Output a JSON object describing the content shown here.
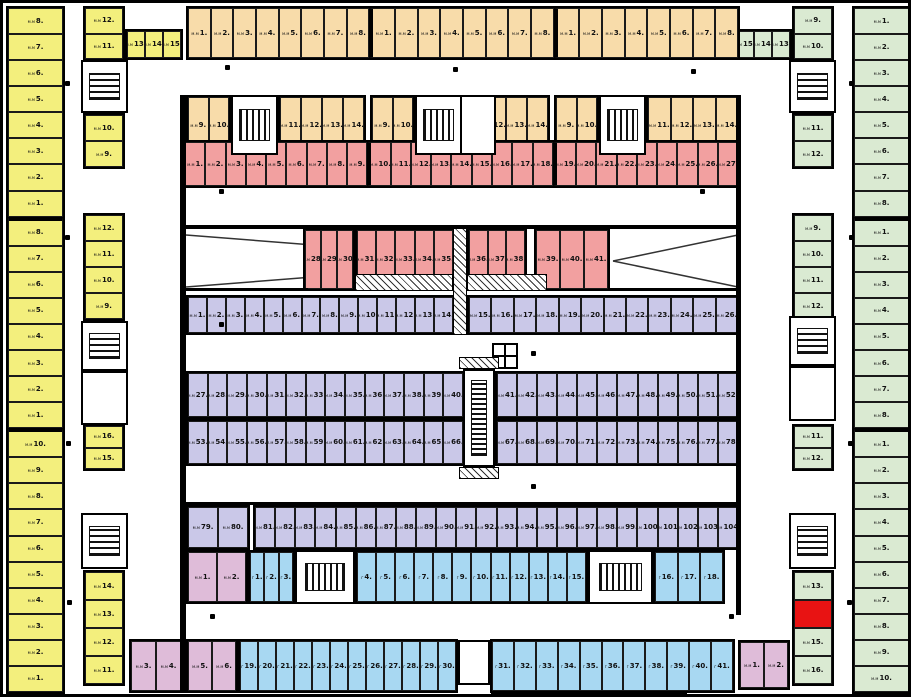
{
  "colors": {
    "yellow": "#f3ef7d",
    "orange": "#f8dcaa",
    "red": "#f2a0a0",
    "purple": "#cac8e8",
    "blue": "#a8d8f2",
    "green": "#daead2",
    "pink": "#dfbcd9",
    "highlight": "#e81313",
    "wall": "#111111",
    "background": "#ffffff"
  },
  "stall_label_prefix_default": "м.м",
  "stall_label_suffix": ".",
  "highlight": {
    "zone_id": "gr-in-5",
    "stall": "14"
  },
  "zones": [
    {
      "id": "yl-outer",
      "color_key": "yellow",
      "prefix": "м.м",
      "stalls": [
        "8",
        "7",
        "6",
        "5",
        "4",
        "3",
        "2",
        "1",
        "8",
        "7",
        "6",
        "5",
        "4",
        "3",
        "2",
        "1",
        "10",
        "9",
        "8",
        "7",
        "6",
        "5",
        "4",
        "3",
        "2",
        "1"
      ]
    },
    {
      "id": "yl-in-1",
      "color_key": "yellow",
      "prefix": "м.м",
      "stalls": [
        "12",
        "11"
      ]
    },
    {
      "id": "yl-in-h",
      "color_key": "yellow",
      "prefix": "м.м",
      "stalls": [
        "13",
        "14",
        "15"
      ]
    },
    {
      "id": "yl-in-2",
      "color_key": "yellow",
      "prefix": "м.м",
      "stalls": [
        "10",
        "9"
      ]
    },
    {
      "id": "yl-in-3",
      "color_key": "yellow",
      "prefix": "м.м",
      "stalls": [
        "12",
        "11",
        "10",
        "9"
      ]
    },
    {
      "id": "yl-in-4",
      "color_key": "yellow",
      "prefix": "м.м",
      "stalls": [
        "16",
        "15"
      ]
    },
    {
      "id": "yl-in-5",
      "color_key": "yellow",
      "prefix": "м.м",
      "stalls": [
        "14",
        "13",
        "12",
        "11"
      ]
    },
    {
      "id": "gr-outer",
      "color_key": "green",
      "prefix": "м.м",
      "stalls": [
        "1",
        "2",
        "3",
        "4",
        "5",
        "6",
        "7",
        "8",
        "1",
        "2",
        "3",
        "4",
        "5",
        "6",
        "7",
        "8",
        "1",
        "2",
        "3",
        "4",
        "5",
        "6",
        "7",
        "8",
        "9",
        "10"
      ]
    },
    {
      "id": "gr-in-1",
      "color_key": "green",
      "prefix": "м.м",
      "stalls": [
        "9",
        "10"
      ]
    },
    {
      "id": "gr-in-h",
      "color_key": "green",
      "prefix": "м.м",
      "stalls": [
        "15",
        "14",
        "13"
      ]
    },
    {
      "id": "gr-in-2",
      "color_key": "green",
      "prefix": "м.м",
      "stalls": [
        "11",
        "12"
      ]
    },
    {
      "id": "gr-in-3",
      "color_key": "green",
      "prefix": "м.м",
      "stalls": [
        "9",
        "10",
        "11",
        "12"
      ]
    },
    {
      "id": "gr-in-4",
      "color_key": "green",
      "prefix": "м.м",
      "stalls": [
        "11",
        "12"
      ]
    },
    {
      "id": "gr-in-5",
      "color_key": "green",
      "prefix": "м.м",
      "stalls": [
        "13",
        "14",
        "15",
        "16"
      ]
    },
    {
      "id": "or-row1",
      "color_key": "orange",
      "prefix": "м.м",
      "stalls": [
        "1",
        "2",
        "3",
        "4",
        "5",
        "6",
        "7",
        "8",
        "1",
        "2",
        "3",
        "4",
        "5",
        "6",
        "7",
        "8",
        "1",
        "2",
        "3",
        "4",
        "5",
        "6",
        "7",
        "8"
      ]
    },
    {
      "id": "or-g1a",
      "color_key": "orange",
      "prefix": "м.м",
      "stalls": [
        "9",
        "10"
      ]
    },
    {
      "id": "or-g1b",
      "color_key": "orange",
      "prefix": "м.м",
      "stalls": [
        "11",
        "12",
        "13",
        "14"
      ]
    },
    {
      "id": "or-g2a",
      "color_key": "orange",
      "prefix": "м.м",
      "stalls": [
        "9",
        "10"
      ]
    },
    {
      "id": "or-g2b",
      "color_key": "orange",
      "prefix": "м.м",
      "stalls": [
        "11",
        "12",
        "13",
        "14"
      ]
    },
    {
      "id": "or-g3a",
      "color_key": "orange",
      "prefix": "м.м",
      "stalls": [
        "9",
        "10"
      ]
    },
    {
      "id": "or-g3b",
      "color_key": "orange",
      "prefix": "м.м",
      "stalls": [
        "11",
        "12",
        "13",
        "14"
      ]
    },
    {
      "id": "rd-row",
      "color_key": "red",
      "prefix": "м.м",
      "stalls": [
        "1",
        "2",
        "3",
        "4",
        "5",
        "6",
        "7",
        "8",
        "9",
        "10",
        "11",
        "12",
        "13",
        "14",
        "15",
        "16",
        "17",
        "18",
        "19",
        "20",
        "21",
        "22",
        "23",
        "24",
        "25",
        "26",
        "27"
      ]
    },
    {
      "id": "rd-b1",
      "color_key": "red",
      "prefix": "м.м",
      "stalls": [
        "28",
        "29",
        "30"
      ]
    },
    {
      "id": "rd-b2",
      "color_key": "red",
      "prefix": "м.м",
      "stalls": [
        "31",
        "32",
        "33",
        "34",
        "35"
      ]
    },
    {
      "id": "rd-b3",
      "color_key": "red",
      "prefix": "м.м",
      "stalls": [
        "36",
        "37",
        "38"
      ]
    },
    {
      "id": "rd-b4",
      "color_key": "red",
      "prefix": "м.м",
      "stalls": [
        "39",
        "40",
        "41"
      ]
    },
    {
      "id": "pu-a1",
      "color_key": "purple",
      "prefix": "м.м",
      "stalls": [
        "1",
        "2",
        "3",
        "4",
        "5",
        "6",
        "7",
        "8",
        "9",
        "10",
        "11",
        "12",
        "13",
        "14"
      ]
    },
    {
      "id": "pu-a2",
      "color_key": "purple",
      "prefix": "м.м",
      "stalls": [
        "15",
        "16",
        "17",
        "18",
        "19",
        "20",
        "21",
        "22",
        "23",
        "24",
        "25",
        "26"
      ]
    },
    {
      "id": "pu-b1",
      "color_key": "purple",
      "prefix": "м.м",
      "stalls": [
        "27",
        "28",
        "29",
        "30",
        "31",
        "32",
        "33",
        "34",
        "35",
        "36",
        "37",
        "38",
        "39",
        "40"
      ]
    },
    {
      "id": "pu-b2",
      "color_key": "purple",
      "prefix": "м.м",
      "stalls": [
        "41",
        "42",
        "43",
        "44",
        "45",
        "46",
        "47",
        "48",
        "49",
        "50",
        "51",
        "52"
      ]
    },
    {
      "id": "pu-c1",
      "color_key": "purple",
      "prefix": "м.м",
      "stalls": [
        "53",
        "54",
        "55",
        "56",
        "57",
        "58",
        "59",
        "60",
        "61",
        "62",
        "63",
        "64",
        "65",
        "66"
      ]
    },
    {
      "id": "pu-c2",
      "color_key": "purple",
      "prefix": "м.м",
      "stalls": [
        "67",
        "68",
        "69",
        "70",
        "71",
        "72",
        "73",
        "74",
        "75",
        "76",
        "77",
        "78"
      ]
    },
    {
      "id": "pu-d1",
      "color_key": "purple",
      "prefix": "м.м",
      "stalls": [
        "79",
        "80"
      ]
    },
    {
      "id": "pu-d2",
      "color_key": "purple",
      "prefix": "м.м",
      "stalls": [
        "81",
        "82",
        "83",
        "84",
        "85",
        "86",
        "87",
        "88",
        "89",
        "90",
        "91",
        "92",
        "93",
        "94",
        "95",
        "96",
        "97",
        "98",
        "99",
        "100",
        "101",
        "102",
        "103",
        "104"
      ]
    },
    {
      "id": "pk-a",
      "color_key": "pink",
      "prefix": "м.м",
      "stalls": [
        "1",
        "2"
      ]
    },
    {
      "id": "bl-a1",
      "color_key": "blue",
      "prefix": "г",
      "stalls": [
        "1",
        "2",
        "3"
      ]
    },
    {
      "id": "bl-a2",
      "color_key": "blue",
      "prefix": "г",
      "stalls": [
        "4",
        "5",
        "6",
        "7",
        "8",
        "9",
        "10",
        "11",
        "12",
        "13",
        "14",
        "15"
      ]
    },
    {
      "id": "bl-a3",
      "color_key": "blue",
      "prefix": "г",
      "stalls": [
        "16",
        "17",
        "18"
      ]
    },
    {
      "id": "pk-b1",
      "color_key": "pink",
      "prefix": "м.м",
      "stalls": [
        "3",
        "4"
      ]
    },
    {
      "id": "pk-b2",
      "color_key": "pink",
      "prefix": "м.м",
      "stalls": [
        "5",
        "6"
      ]
    },
    {
      "id": "bl-b1",
      "color_key": "blue",
      "prefix": "г",
      "stalls": [
        "19",
        "20",
        "21",
        "22",
        "23",
        "24",
        "25",
        "26",
        "27",
        "28",
        "29",
        "30"
      ]
    },
    {
      "id": "bl-b2",
      "color_key": "blue",
      "prefix": "г",
      "stalls": [
        "31",
        "32",
        "33",
        "34",
        "35",
        "36",
        "37",
        "38",
        "39",
        "40",
        "41"
      ]
    },
    {
      "id": "pk-c",
      "color_key": "pink",
      "prefix": "м.м",
      "stalls": [
        "1",
        "2"
      ]
    }
  ]
}
